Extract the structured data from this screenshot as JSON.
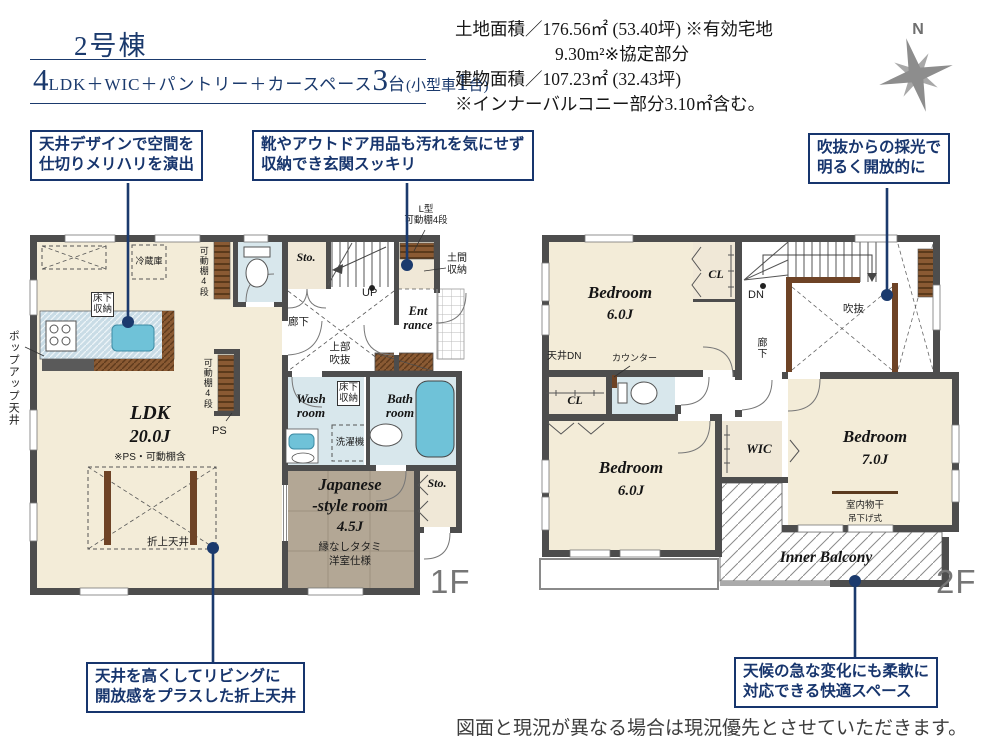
{
  "header": {
    "building": "2号棟",
    "spec": {
      "n1": "4",
      "t1": "LDK＋WIC＋パントリー＋カースペース",
      "n2": "3",
      "t2": "台",
      "t3": "(小型車",
      "n3": "1",
      "t4": "台)"
    },
    "area_line1": "土地面積／176.56㎡ (53.40坪) ※有効宅地",
    "area_line2": "9.30m²※協定部分",
    "area_line3": "建物面積／107.23㎡ (32.43坪)",
    "area_line4": "※インナーバルコニー部分3.10㎡含む。",
    "compass_n": "N"
  },
  "callouts": [
    {
      "line1": "天井デザインで空間を",
      "line2": "仕切りメリハリを演出"
    },
    {
      "line1": "靴やアウトドア用品も汚れを気にせず",
      "line2": "収納でき玄関スッキリ"
    },
    {
      "line1": "吹抜からの採光で",
      "line2": "明るく開放的に"
    },
    {
      "line1": "天井を高くしてリビングに",
      "line2": "開放感をプラスした折上天井"
    },
    {
      "line1": "天候の急な変化にも柔軟に",
      "line2": "対応できる快適スペース"
    }
  ],
  "f1": {
    "floor_label": "1F",
    "ldk_name": "LDK",
    "ldk_size": "20.0J",
    "ldk_note": "※PS・可動棚含",
    "fridge": "冷蔵庫",
    "underfloor1": "床下",
    "underfloor2": "収納",
    "shelf_v": "可動棚4段",
    "popup_ceiling": "ポップアップ天井",
    "oriage": "折上天井",
    "hallway": "廊下",
    "joubu1": "上部",
    "joubu2": "吹抜",
    "up": "UP",
    "lshelf1": "L型",
    "lshelf2": "可動棚4段",
    "doma1": "土間",
    "doma2": "収納",
    "ent1": "Ent",
    "ent2": "rance",
    "sto": "Sto.",
    "wash1": "Wash",
    "wash2": "room",
    "bath1": "Bath",
    "bath2": "room",
    "washer": "洗濯機",
    "jp1": "Japanese",
    "jp2": "-style room",
    "jp3": "4.5J",
    "jp4": "縁なしタタミ",
    "jp5": "洋室仕様",
    "ps": "PS"
  },
  "f2": {
    "floor_label": "2F",
    "bedroom": "Bedroom",
    "b1_size": "6.0J",
    "b2_size": "6.0J",
    "b3_size": "7.0J",
    "cl": "CL",
    "wic": "WIC",
    "dn": "DN",
    "void": "吹抜",
    "hallway": "廊下",
    "ceiling_dn": "天井DN",
    "counter": "カウンター",
    "monohoshi": "室内物干",
    "tsurisage": "吊下げ式",
    "inner_balcony": "Inner Balcony"
  },
  "footer": {
    "disclaimer": "図面と現況が異なる場合は現況優先とさせていただきます。"
  }
}
